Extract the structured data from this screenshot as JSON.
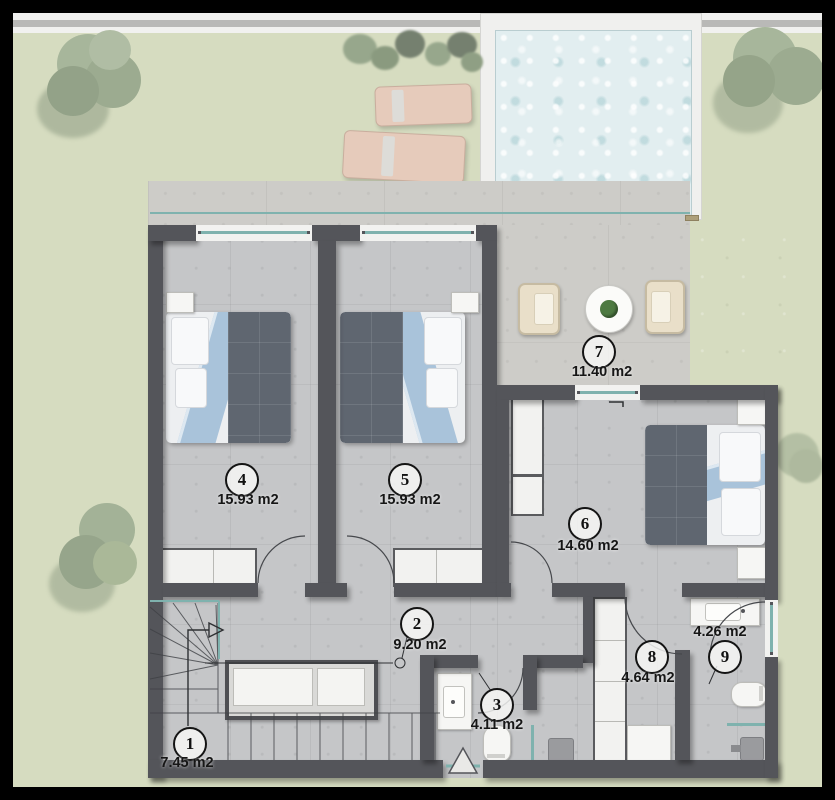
{
  "scene": {
    "kind": "architectural floor plan, top view, upper floor with pool terrace"
  },
  "rooms": [
    {
      "number": "1",
      "area": "7.45 m2"
    },
    {
      "number": "2",
      "area": "9.20 m2"
    },
    {
      "number": "3",
      "area": "4.11 m2"
    },
    {
      "number": "4",
      "area": "15.93 m2"
    },
    {
      "number": "5",
      "area": "15.93 m2"
    },
    {
      "number": "6",
      "area": "14.60 m2"
    },
    {
      "number": "7",
      "area": "11.40 m2"
    },
    {
      "number": "8",
      "area": "4.64 m2"
    },
    {
      "number": "9",
      "area": "4.26 m2"
    }
  ],
  "palette": {
    "background": "#000000",
    "grass": "#d6dcc0",
    "concrete_deck": "#cdccc8",
    "interior_floor": "#c5c6c8",
    "wall": "#54555a",
    "pool_water": "#e2eef0",
    "pool_deck": "#f0f0ee",
    "glass": "#7fb2ae",
    "lounger": "#e6cbbb",
    "armchair": "#e9dfc9",
    "bed_duvet": "#5f6670",
    "bed_blanket": "#a9c3da",
    "tree": "#a3b297",
    "pergola_hatch": "#ad9f7a"
  }
}
